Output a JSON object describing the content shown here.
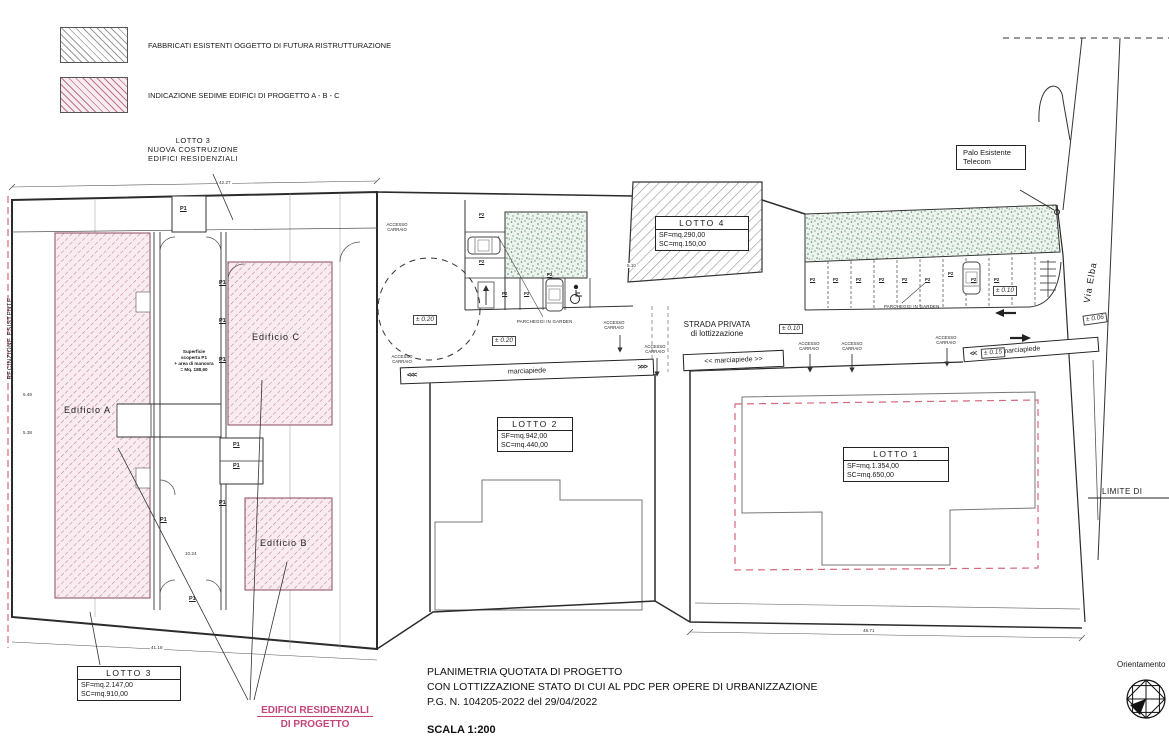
{
  "legend": {
    "items": [
      {
        "label": "FABBRICATI ESISTENTI OGGETTO DI FUTURA RISTRUTTURAZIONE",
        "swatch": "gray-hatch"
      },
      {
        "label": "INDICAZIONE SEDIME EDIFICI DI PROGETTO  A - B - C",
        "swatch": "pink-hatch"
      }
    ]
  },
  "colors": {
    "line": "#2b2b2b",
    "hatch_gray": "#9a9a9a",
    "hatch_pink": "#c0718c",
    "pink_fill": "#f8ecf1",
    "green_garden": "#58876a",
    "fence_dashed": "#d4687c",
    "pink_accent": "#c4457c"
  },
  "annotations": {
    "lotto3_callout": "LOTTO  3\nNUOVA  COSTRUZIONE\nEDIFICI  RESIDENZIALI",
    "palo_telecom": "Palo\nEsistente\nTelecom",
    "via_elba": "Via Elba",
    "recinzione": "RECINZIONE  ESISTENTE",
    "limite": "LIMITE  DI",
    "strada_privata": "STRADA  PRIVATA\ndi  lottizzazione",
    "edificio_a": "Edificio  A",
    "edificio_b": "Edificio  B",
    "edificio_c": "Edificio  C",
    "superficie_note": "Superficie\nscoperta P1\n+ area di manovra\n= Mq. 188,60",
    "orientamento": "Orientamento",
    "progetto_note_line1": "EDIFICI RESIDENZIALI",
    "progetto_note_line2": "DI PROGETTO"
  },
  "lots": [
    {
      "name": "LOTTO  4",
      "vals": "SF=mq.290,00\nSC=mq.150,00"
    },
    {
      "name": "LOTTO  2",
      "vals": "SF=mq.942,00\nSC=mq.440,00"
    },
    {
      "name": "LOTTO  1",
      "vals": "SF=mq.1.354,00\nSC=mq.650,00"
    },
    {
      "name": "LOTTO  3",
      "vals": "SF=mq.2.147,00\nSC=mq.910,00"
    }
  ],
  "bands": {
    "left": {
      "pre": "<<<",
      "label": "marciapiede",
      "post": ">>>"
    },
    "mid": {
      "label": "<< marciapiede >>"
    },
    "right": {
      "pre": "<<",
      "label": "marciapiede"
    }
  },
  "labels": {
    "p1": [
      {
        "t": "P1",
        "x": 180,
        "y": 206
      },
      {
        "t": "P1",
        "x": 219,
        "y": 318
      },
      {
        "t": "P1",
        "x": 219,
        "y": 357
      },
      {
        "t": "P1",
        "x": 233,
        "y": 442
      },
      {
        "t": "P1",
        "x": 233,
        "y": 463
      },
      {
        "t": "P1",
        "x": 219,
        "y": 500
      },
      {
        "t": "P1",
        "x": 160,
        "y": 517
      },
      {
        "t": "P1",
        "x": 189,
        "y": 596
      },
      {
        "t": "P1",
        "x": 219,
        "y": 280
      }
    ],
    "p2": [
      {
        "t": "P2",
        "x": 479,
        "y": 212
      },
      {
        "t": "P2",
        "x": 479,
        "y": 259
      },
      {
        "t": "P2",
        "x": 502,
        "y": 291
      },
      {
        "t": "P2",
        "x": 524,
        "y": 291
      },
      {
        "t": "P2",
        "x": 547,
        "y": 272
      },
      {
        "t": "P2",
        "x": 810,
        "y": 277
      },
      {
        "t": "P2",
        "x": 833,
        "y": 277
      },
      {
        "t": "P2",
        "x": 856,
        "y": 277
      },
      {
        "t": "P2",
        "x": 879,
        "y": 277
      },
      {
        "t": "P2",
        "x": 902,
        "y": 277
      },
      {
        "t": "P2",
        "x": 925,
        "y": 277
      },
      {
        "t": "P2",
        "x": 948,
        "y": 271
      },
      {
        "t": "P2",
        "x": 971,
        "y": 277
      },
      {
        "t": "P2",
        "x": 994,
        "y": 277
      }
    ],
    "accesso": [
      {
        "t": "ACCESSO\nCARRAIO",
        "x": 383,
        "y": 222
      },
      {
        "t": "ACCESSO\nCARRAIO",
        "x": 388,
        "y": 354
      },
      {
        "t": "ACCESSO\nCARRAIO",
        "x": 600,
        "y": 320
      },
      {
        "t": "ACCESSO\nCARRAIO",
        "x": 641,
        "y": 344
      },
      {
        "t": "ACCESSO\nCARRAIO",
        "x": 795,
        "y": 341
      },
      {
        "t": "ACCESSO\nCARRAIO",
        "x": 838,
        "y": 341
      },
      {
        "t": "ACCESSO\nCARRAIO",
        "x": 932,
        "y": 335
      }
    ],
    "elev": [
      {
        "t": "± 0.20",
        "x": 413,
        "y": 315
      },
      {
        "t": "± 0.20",
        "x": 492,
        "y": 336
      },
      {
        "t": "± 0.10",
        "x": 779,
        "y": 324
      },
      {
        "t": "± 0.10",
        "x": 993,
        "y": 286
      },
      {
        "t": "± 0.15",
        "x": 981,
        "y": 348,
        "rot": -4
      },
      {
        "t": "± 0.06",
        "x": 1083,
        "y": 314,
        "rot": -8
      }
    ],
    "dims": [
      {
        "t": "42.27",
        "x": 218,
        "y": 180
      },
      {
        "t": "48.71",
        "x": 862,
        "y": 628
      },
      {
        "t": "41.18",
        "x": 150,
        "y": 645
      },
      {
        "t": "10.24",
        "x": 184,
        "y": 551
      },
      {
        "t": "5.48",
        "x": 22,
        "y": 392
      },
      {
        "t": "5.38",
        "x": 22,
        "y": 430
      },
      {
        "t": "5.10",
        "x": 626,
        "y": 263
      }
    ],
    "parcheggi": [
      {
        "t": "PARCHEGGI IN GARDEN",
        "x": 517,
        "y": 319
      },
      {
        "t": "PARCHEGGI IN GARDEN",
        "x": 884,
        "y": 304
      }
    ]
  },
  "title_block": {
    "line1": "PLANIMETRIA QUOTATA DI PROGETTO",
    "line2": "CON LOTTIZZAZIONE STATO DI CUI AL PDC PER OPERE DI URBANIZZAZIONE",
    "line3": "P.G. N. 104205-2022 del 29/04/2022",
    "scale": "SCALA 1:200"
  }
}
